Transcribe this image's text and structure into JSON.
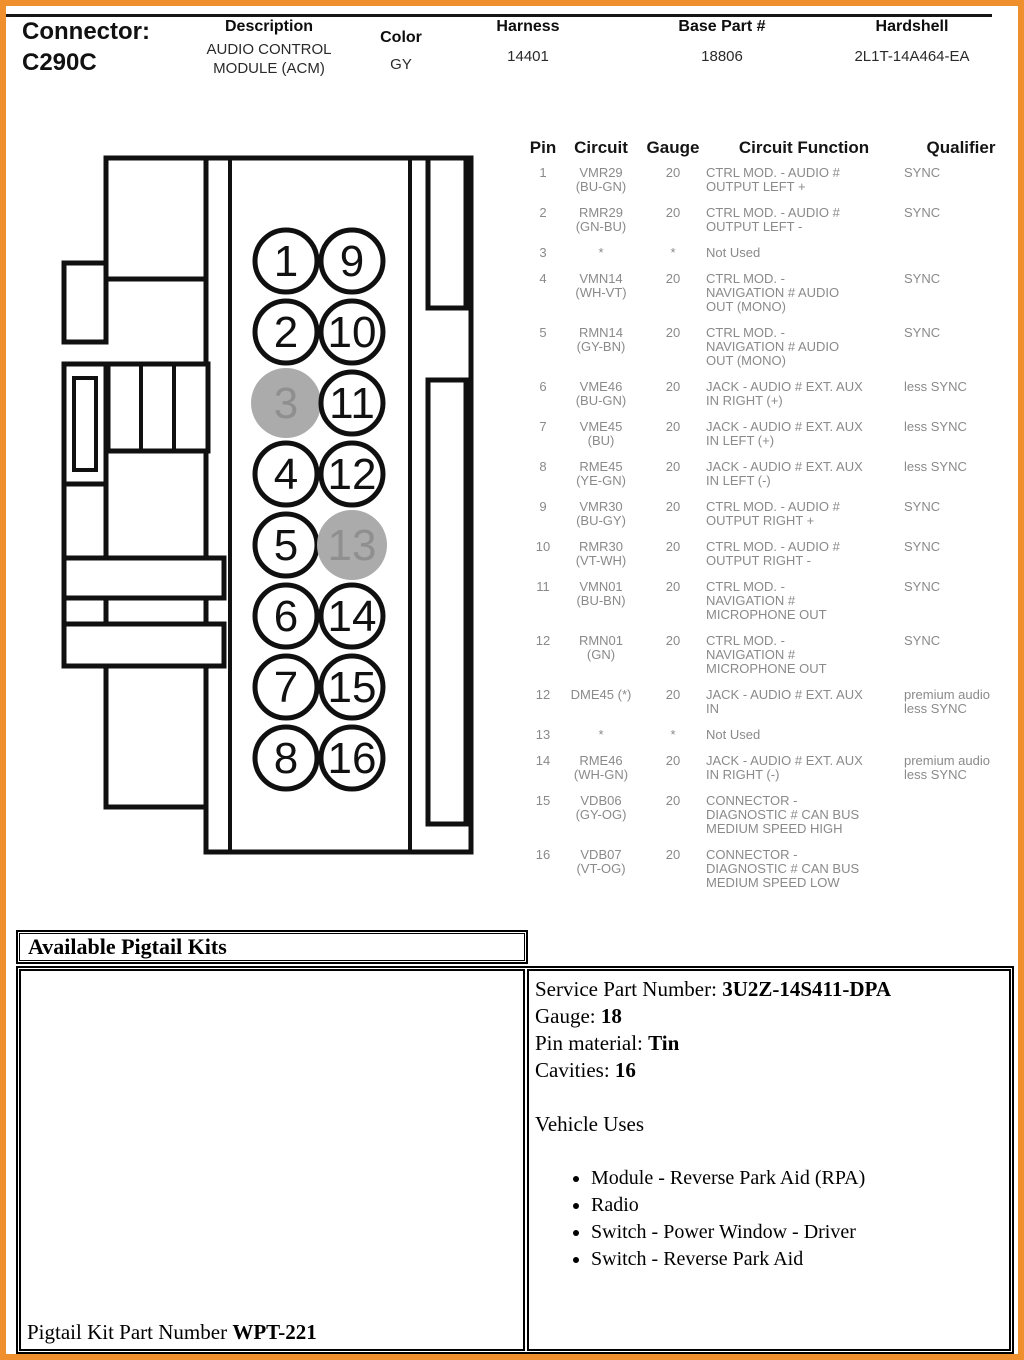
{
  "page": {
    "border_color": "#EF8F2D"
  },
  "header": {
    "connector_block": "Connector:\nC290C",
    "fields": [
      {
        "label": "Description",
        "value": "AUDIO CONTROL\nMODULE (ACM)"
      },
      {
        "label": "Color",
        "value": "GY"
      },
      {
        "label": "Harness",
        "value": "14401"
      },
      {
        "label": "Base Part #",
        "value": "18806"
      },
      {
        "label": "Hardshell",
        "value": "2L1T-14A464-EA"
      }
    ]
  },
  "connector_diagram": {
    "pins_left": [
      "1",
      "2",
      "3",
      "4",
      "5",
      "6",
      "7",
      "8"
    ],
    "pins_right": [
      "9",
      "10",
      "11",
      "12",
      "13",
      "14",
      "15",
      "16"
    ],
    "shaded_pins": [
      "3",
      "13"
    ],
    "pin_fill": "#ffffff",
    "shaded_fill": "#ABABAB",
    "outline_color": "#101010",
    "shaded_number_color": "#8F8F8F"
  },
  "pin_table": {
    "headers": [
      "Pin",
      "Circuit",
      "Gauge",
      "Circuit Function",
      "Qualifier"
    ],
    "rows": [
      {
        "pin": "1",
        "circuit": "VMR29\n(BU-GN)",
        "gauge": "20",
        "function": "CTRL MOD. - AUDIO #\nOUTPUT LEFT +",
        "qualifier": "SYNC"
      },
      {
        "pin": "2",
        "circuit": "RMR29\n(GN-BU)",
        "gauge": "20",
        "function": "CTRL MOD. - AUDIO #\nOUTPUT LEFT -",
        "qualifier": "SYNC"
      },
      {
        "pin": "3",
        "circuit": "*",
        "gauge": "*",
        "function": "Not Used",
        "qualifier": ""
      },
      {
        "pin": "4",
        "circuit": "VMN14\n(WH-VT)",
        "gauge": "20",
        "function": "CTRL MOD. -\nNAVIGATION # AUDIO\nOUT (MONO)",
        "qualifier": "SYNC"
      },
      {
        "pin": "5",
        "circuit": "RMN14\n(GY-BN)",
        "gauge": "20",
        "function": "CTRL MOD. -\nNAVIGATION # AUDIO\nOUT (MONO)",
        "qualifier": "SYNC"
      },
      {
        "pin": "6",
        "circuit": "VME46\n(BU-GN)",
        "gauge": "20",
        "function": "JACK - AUDIO # EXT. AUX\nIN RIGHT (+)",
        "qualifier": "less SYNC"
      },
      {
        "pin": "7",
        "circuit": "VME45\n(BU)",
        "gauge": "20",
        "function": "JACK - AUDIO # EXT. AUX\nIN LEFT (+)",
        "qualifier": "less SYNC"
      },
      {
        "pin": "8",
        "circuit": "RME45\n(YE-GN)",
        "gauge": "20",
        "function": "JACK - AUDIO # EXT. AUX\nIN LEFT (-)",
        "qualifier": "less SYNC"
      },
      {
        "pin": "9",
        "circuit": "VMR30\n(BU-GY)",
        "gauge": "20",
        "function": "CTRL MOD. - AUDIO #\nOUTPUT RIGHT +",
        "qualifier": "SYNC"
      },
      {
        "pin": "10",
        "circuit": "RMR30\n(VT-WH)",
        "gauge": "20",
        "function": "CTRL MOD. - AUDIO #\nOUTPUT RIGHT -",
        "qualifier": "SYNC"
      },
      {
        "pin": "11",
        "circuit": "VMN01\n(BU-BN)",
        "gauge": "20",
        "function": "CTRL MOD. -\nNAVIGATION #\nMICROPHONE OUT",
        "qualifier": "SYNC"
      },
      {
        "pin": "12",
        "circuit": "RMN01\n(GN)",
        "gauge": "20",
        "function": "CTRL MOD. -\nNAVIGATION #\nMICROPHONE OUT",
        "qualifier": "SYNC"
      },
      {
        "pin": "12",
        "circuit": "DME45 (*)",
        "gauge": "20",
        "function": "JACK - AUDIO # EXT. AUX\nIN",
        "qualifier": "premium audio\nless SYNC"
      },
      {
        "pin": "13",
        "circuit": "*",
        "gauge": "*",
        "function": "Not Used",
        "qualifier": ""
      },
      {
        "pin": "14",
        "circuit": "RME46\n(WH-GN)",
        "gauge": "20",
        "function": "JACK - AUDIO # EXT. AUX\nIN RIGHT (-)",
        "qualifier": "premium audio\nless SYNC"
      },
      {
        "pin": "15",
        "circuit": "VDB06\n(GY-OG)",
        "gauge": "20",
        "function": "CONNECTOR -\nDIAGNOSTIC # CAN BUS\nMEDIUM SPEED HIGH",
        "qualifier": ""
      },
      {
        "pin": "16",
        "circuit": "VDB07\n(VT-OG)",
        "gauge": "20",
        "function": "CONNECTOR -\nDIAGNOSTIC # CAN BUS\nMEDIUM SPEED LOW",
        "qualifier": ""
      }
    ]
  },
  "pigtail": {
    "section_title": "Available Pigtail Kits",
    "details": [
      {
        "label": "Service Part Number: ",
        "value": "3U2Z-14S411-DPA"
      },
      {
        "label": "Gauge: ",
        "value": "18"
      },
      {
        "label": "Pin material: ",
        "value": "Tin"
      },
      {
        "label": "Cavities: ",
        "value": "16"
      }
    ],
    "vehicle_uses_title": "Vehicle Uses",
    "vehicle_uses": [
      "Module - Reverse Park Aid (RPA)",
      "Radio",
      "Switch - Power Window - Driver",
      "Switch - Reverse Park Aid"
    ],
    "kit_label": "Pigtail Kit Part Number ",
    "kit_value": "WPT-221"
  }
}
